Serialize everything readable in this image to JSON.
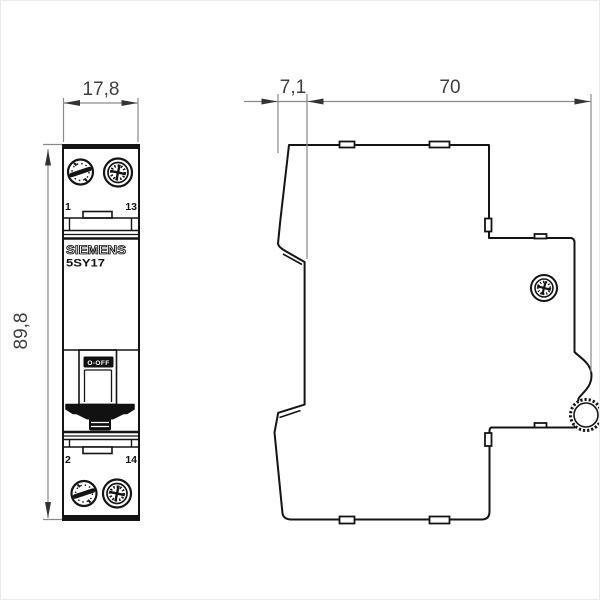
{
  "page": {
    "background": "#ffffff",
    "kind": "technical-dimension-drawing"
  },
  "dimensions": {
    "front_width_mm": "17,8",
    "front_height_mm": "89,8",
    "side_front_depth_mm": "7,1",
    "side_depth_mm": "70"
  },
  "front_view": {
    "brand": "SIEMENS",
    "model": "5SY17",
    "toggle_label": "O-OFF",
    "terminals": {
      "top_left": "1",
      "top_right": "13",
      "bottom_left": "2",
      "bottom_right": "14"
    }
  },
  "icons": {
    "front_top_left": "pozidriv-screw-icon",
    "front_top_right": "combi-screw-icon",
    "front_bottom_left": "pozidriv-screw-icon",
    "front_bottom_right": "combi-screw-icon",
    "side_terminal": "combi-screw-icon",
    "din_clip": "din-clip-wheel-icon"
  },
  "colors": {
    "outline": "#141414",
    "dimension_line": "#8a8a8a",
    "dimension_text": "#3f3f3f",
    "toggle_fill": "#111111"
  }
}
